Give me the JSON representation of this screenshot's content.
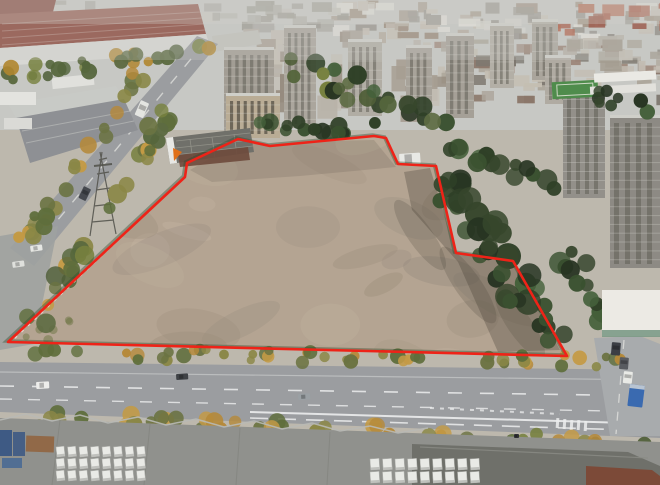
{
  "scene": {
    "subject": "aerial-photo-vacant-land-parcel",
    "parcel": {
      "surface": "bare-earth",
      "outline_color": "#ee2318",
      "boundary_points": [
        [
          8,
          342
        ],
        [
          185,
          177
        ],
        [
          187,
          163
        ],
        [
          238,
          139
        ],
        [
          270,
          146
        ],
        [
          374,
          136
        ],
        [
          386,
          138
        ],
        [
          398,
          164
        ],
        [
          436,
          166
        ],
        [
          456,
          253
        ],
        [
          513,
          261
        ],
        [
          567,
          356
        ]
      ]
    },
    "palette": {
      "boundary_red": "#ee2318",
      "dirt": "#b4a492",
      "dirt_light": "#c9bca8",
      "dirt_dark": "#9c8d7a",
      "mottle_gray": "#8f857a",
      "shadow": "#423c33",
      "road": "#9b9da0",
      "road_light": "#a8abad",
      "lane_white": "#eceded",
      "tree_dark": "#36462c",
      "tree_green": "#5d6b42",
      "tree_autumn": "#b5893a",
      "factory_maroon": "#8a4438",
      "factory_dark_red": "#772e24",
      "warehouse": "#90918d",
      "warehouse_dark": "#6f706a",
      "haze": "#c7c8c4",
      "white_bldg": "#eceae4",
      "field_green": "#4f8c4c",
      "truck_blue": "#3a6ab0",
      "container_blue": "#3e5a84",
      "rust": "#92613c",
      "marker_orange": "#e07018",
      "brick_roof_red": "#a34a34"
    },
    "vehicles": [
      {
        "name": "white-van",
        "x": 399,
        "y": 154,
        "w": 21,
        "h": 11,
        "rot": -4,
        "color": "#e8e9e5"
      },
      {
        "name": "white-truck",
        "x": 141,
        "y": 100,
        "w": 9,
        "h": 16,
        "rot": 24,
        "color": "#e4e5e1"
      },
      {
        "name": "dark-car",
        "x": 84,
        "y": 186,
        "w": 8,
        "h": 13,
        "rot": 26,
        "color": "#45484e"
      },
      {
        "name": "white-car",
        "x": 30,
        "y": 246,
        "w": 12,
        "h": 6,
        "rot": -8,
        "color": "#e6e7e3"
      },
      {
        "name": "white-car",
        "x": 12,
        "y": 262,
        "w": 12,
        "h": 6,
        "rot": -8,
        "color": "#dfe0dc"
      },
      {
        "name": "white-car",
        "x": 36,
        "y": 382,
        "w": 13,
        "h": 7,
        "rot": -3,
        "color": "#ededeb"
      },
      {
        "name": "dark-car",
        "x": 176,
        "y": 374,
        "w": 12,
        "h": 6,
        "rot": -3,
        "color": "#3f4246"
      },
      {
        "name": "gray-car",
        "x": 298,
        "y": 394,
        "w": 12,
        "h": 6,
        "rot": -3,
        "color": "#9aa0a4"
      },
      {
        "name": "scooter",
        "x": 514,
        "y": 434,
        "w": 5,
        "h": 4,
        "rot": 0,
        "color": "#2e2f33"
      },
      {
        "name": "dark-suv",
        "x": 612,
        "y": 342,
        "w": 9,
        "h": 13,
        "rot": 5,
        "color": "#3b3e44"
      },
      {
        "name": "gray-suv",
        "x": 620,
        "y": 357,
        "w": 9,
        "h": 12,
        "rot": 5,
        "color": "#585b60"
      },
      {
        "name": "white-car",
        "x": 624,
        "y": 371,
        "w": 9,
        "h": 12,
        "rot": 6,
        "color": "#e9eae6"
      },
      {
        "name": "blue-truck",
        "x": 630,
        "y": 384,
        "w": 15,
        "h": 22,
        "rot": 7,
        "color": "#3a6ab0"
      }
    ],
    "truck_yards": [
      {
        "x": 56,
        "y": 447,
        "rows": 3,
        "cols": 8,
        "dx": 11.5,
        "dy": 12,
        "w": 8,
        "h": 10,
        "rot": -6
      },
      {
        "x": 370,
        "y": 459,
        "rows": 2,
        "cols": 9,
        "dx": 12.5,
        "dy": 13,
        "w": 9,
        "h": 11,
        "rot": -4
      }
    ]
  }
}
